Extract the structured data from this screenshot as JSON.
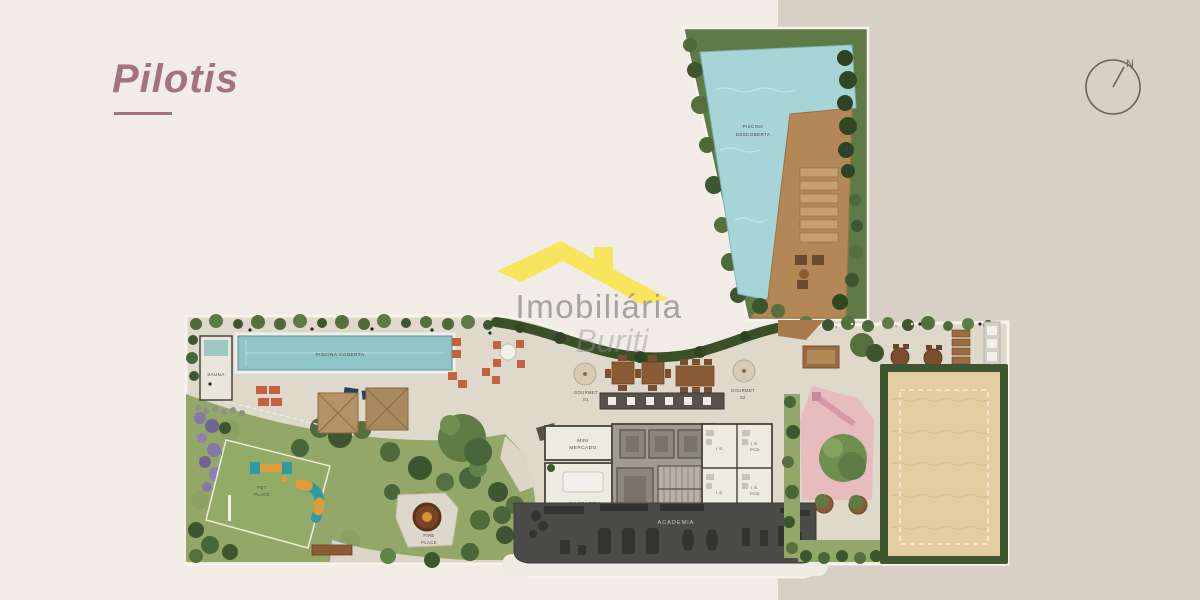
{
  "page": {
    "title": "Pilotis"
  },
  "compass": {
    "label": "N"
  },
  "watermark": {
    "brand": "Imobiliária",
    "script": "Buriti"
  },
  "colors": {
    "background_left": "#F1EDE6",
    "background_right": "#D8D0C5",
    "title_accent": "#A4737E",
    "watermark_yellow": "#F8E55E",
    "watermark_gray": "#9D9D9B",
    "pool_water": "#8FC4C8",
    "top_pool_water": "#A7D4D6",
    "wood_deck": "#B48756",
    "lawn_green": "#93A768",
    "hedge_green": "#3A5128",
    "sand_court": "#E5CDA2",
    "kids_pink": "#E7BCBE",
    "gym_gray": "#4B4B49",
    "concrete": "#DFD9CC",
    "compass_brown": "#6F6054"
  },
  "plan": {
    "labels": {
      "piscina_descoberta": {
        "line1": "PISCINA",
        "line2": "DESCOBERTA"
      },
      "piscina_coberta": "PISCINA COBERTA",
      "sauna": "SAUNA",
      "gourmet_01": {
        "line1": "GOURMET",
        "line2": "01"
      },
      "gourmet_02": {
        "line1": "GOURMET",
        "line2": "02"
      },
      "mini_mercado": {
        "line1": "MINI",
        "line2": "MERCADO"
      },
      "massagem": "MASSAGEM",
      "wc_1a": "I.S.",
      "wc_1b": {
        "line1": "I.S.",
        "line2": "PCD"
      },
      "wc_2a": "I.S.",
      "wc_2b": {
        "line1": "I.S.",
        "line2": "PCD"
      },
      "academia": "ACADEMIA",
      "fire_place": {
        "line1": "FIRE",
        "line2": "PLACE"
      },
      "pet_place": {
        "line1": "PET",
        "line2": "PLACE"
      }
    }
  }
}
